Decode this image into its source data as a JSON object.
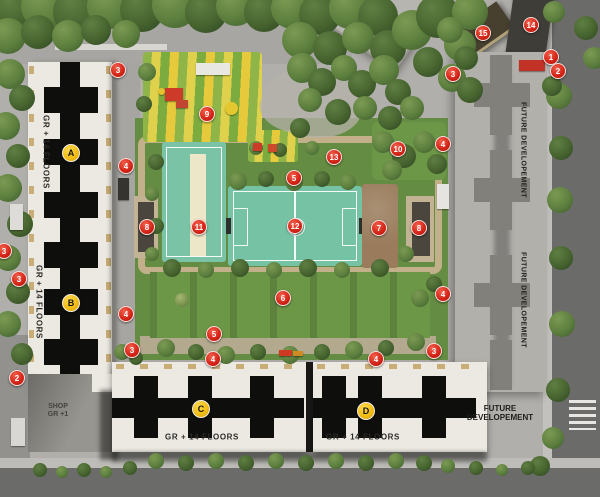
{
  "texts": {
    "floors_label": "GR + 14 FLOORS",
    "shop_line1": "SHOP",
    "shop_line2": "GR +1",
    "future_vertical": "FUTURE DEVELOPEMENT",
    "future_line1": "FUTURE",
    "future_line2": "DEVELOPEMENT"
  },
  "markers": {
    "numbers": [
      {
        "label": "1",
        "x": 550,
        "y": 56
      },
      {
        "label": "2",
        "x": 557,
        "y": 70
      },
      {
        "label": "2",
        "x": 16,
        "y": 377
      },
      {
        "label": "3",
        "x": 117,
        "y": 69
      },
      {
        "label": "3",
        "x": 452,
        "y": 73
      },
      {
        "label": "3",
        "x": 3,
        "y": 250
      },
      {
        "label": "3",
        "x": 18,
        "y": 278
      },
      {
        "label": "3",
        "x": 131,
        "y": 349
      },
      {
        "label": "3",
        "x": 433,
        "y": 350
      },
      {
        "label": "4",
        "x": 125,
        "y": 165
      },
      {
        "label": "4",
        "x": 125,
        "y": 313
      },
      {
        "label": "4",
        "x": 442,
        "y": 143
      },
      {
        "label": "4",
        "x": 442,
        "y": 293
      },
      {
        "label": "4",
        "x": 212,
        "y": 358
      },
      {
        "label": "4",
        "x": 375,
        "y": 358
      },
      {
        "label": "5",
        "x": 293,
        "y": 177
      },
      {
        "label": "5",
        "x": 213,
        "y": 333
      },
      {
        "label": "6",
        "x": 282,
        "y": 297
      },
      {
        "label": "7",
        "x": 378,
        "y": 227
      },
      {
        "label": "8",
        "x": 146,
        "y": 226
      },
      {
        "label": "8",
        "x": 418,
        "y": 227
      },
      {
        "label": "9",
        "x": 206,
        "y": 113
      },
      {
        "label": "10",
        "x": 397,
        "y": 148
      },
      {
        "label": "11",
        "x": 198,
        "y": 226
      },
      {
        "label": "12",
        "x": 294,
        "y": 225
      },
      {
        "label": "13",
        "x": 333,
        "y": 156
      },
      {
        "label": "14",
        "x": 530,
        "y": 24
      },
      {
        "label": "15",
        "x": 482,
        "y": 32
      }
    ],
    "letters": [
      {
        "label": "A",
        "x": 70,
        "y": 152
      },
      {
        "label": "B",
        "x": 70,
        "y": 302
      },
      {
        "label": "C",
        "x": 200,
        "y": 408
      },
      {
        "label": "D",
        "x": 365,
        "y": 410
      }
    ]
  },
  "colors": {
    "marker_red": "#d6271a",
    "marker_yellow": "#efba10",
    "court_teal": "#7ac3a7",
    "pitch_teal": "#76c2a5",
    "cream_strip": "#eee6c8",
    "lawn_green": "#6c9747",
    "playground_yellow": "#ddd14b",
    "playground_green": "#8ab447",
    "sand_brown": "#9a7c5c",
    "road_grey": "#6b6b69",
    "building_white": "#ece9e2",
    "tower_core_black": "#0e0e0c",
    "future_building_grey": "#b2b0ab",
    "stone_path": "#c1b08a"
  },
  "scene": {
    "trees": [
      [
        15,
        10,
        22,
        2
      ],
      [
        45,
        6,
        24,
        1
      ],
      [
        78,
        12,
        25,
        2
      ],
      [
        110,
        6,
        23,
        1
      ],
      [
        142,
        10,
        22,
        2
      ],
      [
        175,
        5,
        23,
        1
      ],
      [
        206,
        12,
        21,
        2
      ],
      [
        236,
        6,
        20,
        1
      ],
      [
        264,
        12,
        20,
        2
      ],
      [
        292,
        8,
        21,
        1
      ],
      [
        320,
        14,
        21,
        2
      ],
      [
        350,
        8,
        21,
        1
      ],
      [
        378,
        16,
        20,
        2
      ],
      [
        8,
        36,
        18,
        1
      ],
      [
        38,
        32,
        17,
        2
      ],
      [
        68,
        36,
        16,
        1
      ],
      [
        96,
        30,
        15,
        2
      ],
      [
        126,
        34,
        14,
        1
      ],
      [
        300,
        40,
        18,
        1
      ],
      [
        330,
        48,
        17,
        2
      ],
      [
        358,
        38,
        16,
        1
      ],
      [
        388,
        48,
        18,
        2
      ],
      [
        412,
        30,
        20,
        1
      ],
      [
        438,
        16,
        22,
        2
      ],
      [
        460,
        45,
        16,
        1
      ],
      [
        470,
        12,
        18,
        1
      ],
      [
        428,
        62,
        15,
        2
      ],
      [
        452,
        78,
        14,
        1
      ],
      [
        470,
        90,
        13,
        2
      ],
      [
        302,
        68,
        15,
        1
      ],
      [
        322,
        82,
        14,
        2
      ],
      [
        344,
        68,
        13,
        1
      ],
      [
        362,
        84,
        14,
        2
      ],
      [
        384,
        70,
        15,
        1
      ],
      [
        398,
        92,
        13,
        2
      ],
      [
        310,
        100,
        12,
        1
      ],
      [
        338,
        112,
        13,
        2
      ],
      [
        365,
        108,
        12,
        1
      ],
      [
        390,
        118,
        12,
        2
      ],
      [
        412,
        108,
        12,
        1
      ],
      [
        300,
        128,
        10,
        2
      ],
      [
        383,
        142,
        11,
        1
      ],
      [
        404,
        156,
        12,
        2
      ],
      [
        424,
        142,
        11,
        1
      ],
      [
        437,
        164,
        10,
        2
      ],
      [
        392,
        170,
        10,
        1
      ],
      [
        10,
        74,
        15,
        1
      ],
      [
        22,
        98,
        13,
        2
      ],
      [
        6,
        126,
        14,
        1
      ],
      [
        18,
        156,
        12,
        2
      ],
      [
        8,
        188,
        14,
        1
      ],
      [
        20,
        224,
        13,
        2
      ],
      [
        8,
        258,
        13,
        1
      ],
      [
        18,
        292,
        12,
        2
      ],
      [
        8,
        324,
        13,
        1
      ],
      [
        22,
        354,
        11,
        2
      ],
      [
        559,
        96,
        13,
        1
      ],
      [
        561,
        148,
        12,
        2
      ],
      [
        560,
        200,
        13,
        1
      ],
      [
        561,
        258,
        12,
        2
      ],
      [
        562,
        324,
        13,
        1
      ],
      [
        558,
        390,
        12,
        2
      ],
      [
        553,
        438,
        11,
        1
      ],
      [
        540,
        466,
        10,
        2
      ],
      [
        450,
        30,
        13,
        1
      ],
      [
        466,
        58,
        12,
        2
      ],
      [
        554,
        12,
        11,
        1
      ],
      [
        586,
        28,
        12,
        2
      ],
      [
        594,
        58,
        11,
        1
      ],
      [
        552,
        86,
        10,
        2
      ],
      [
        238,
        181,
        9,
        1
      ],
      [
        266,
        179,
        8,
        2
      ],
      [
        294,
        182,
        9,
        1
      ],
      [
        322,
        179,
        8,
        2
      ],
      [
        348,
        182,
        8,
        1
      ],
      [
        156,
        162,
        8,
        2
      ],
      [
        152,
        194,
        7,
        1
      ],
      [
        156,
        226,
        8,
        2
      ],
      [
        152,
        254,
        7,
        1
      ],
      [
        172,
        268,
        9,
        2
      ],
      [
        206,
        270,
        8,
        1
      ],
      [
        240,
        268,
        9,
        2
      ],
      [
        274,
        270,
        8,
        1
      ],
      [
        308,
        268,
        9,
        2
      ],
      [
        342,
        270,
        8,
        1
      ],
      [
        380,
        268,
        9,
        2
      ],
      [
        406,
        254,
        8,
        1
      ],
      [
        166,
        348,
        9,
        1
      ],
      [
        196,
        352,
        8,
        2
      ],
      [
        226,
        355,
        9,
        1
      ],
      [
        258,
        352,
        8,
        2
      ],
      [
        290,
        355,
        9,
        1
      ],
      [
        322,
        352,
        8,
        2
      ],
      [
        354,
        350,
        9,
        1
      ],
      [
        386,
        348,
        8,
        2
      ],
      [
        416,
        342,
        9,
        1
      ],
      [
        182,
        300,
        7,
        3
      ],
      [
        420,
        298,
        9,
        1
      ],
      [
        434,
        284,
        8,
        2
      ],
      [
        256,
        148,
        7,
        1
      ],
      [
        280,
        150,
        7,
        2
      ],
      [
        312,
        148,
        7,
        1
      ],
      [
        147,
        72,
        9,
        1
      ],
      [
        144,
        104,
        8,
        2
      ],
      [
        122,
        352,
        8,
        1
      ],
      [
        136,
        358,
        7,
        2
      ],
      [
        40,
        470,
        7,
        2
      ],
      [
        62,
        472,
        6,
        1
      ],
      [
        84,
        470,
        7,
        2
      ],
      [
        106,
        472,
        6,
        1
      ],
      [
        130,
        468,
        7,
        2
      ],
      [
        156,
        461,
        8,
        1
      ],
      [
        186,
        463,
        8,
        2
      ],
      [
        216,
        461,
        8,
        1
      ],
      [
        246,
        463,
        8,
        2
      ],
      [
        276,
        461,
        8,
        1
      ],
      [
        306,
        463,
        8,
        2
      ],
      [
        336,
        461,
        8,
        1
      ],
      [
        366,
        463,
        8,
        2
      ],
      [
        396,
        461,
        8,
        1
      ],
      [
        424,
        463,
        8,
        2
      ],
      [
        448,
        466,
        7,
        1
      ],
      [
        476,
        468,
        7,
        2
      ],
      [
        502,
        470,
        6,
        1
      ],
      [
        528,
        468,
        7,
        2
      ]
    ],
    "objects": [
      {
        "x": 196,
        "y": 63,
        "w": 34,
        "h": 12,
        "color": "#e9e7e2",
        "name": "vehicle-white-top"
      },
      {
        "x": 118,
        "y": 178,
        "w": 11,
        "h": 22,
        "color": "#35342f",
        "name": "vehicle-dark-driveway"
      },
      {
        "x": 10,
        "y": 204,
        "w": 13,
        "h": 26,
        "color": "#dedcd8",
        "name": "vehicle-white-left"
      },
      {
        "x": 11,
        "y": 418,
        "w": 14,
        "h": 28,
        "color": "#d9d7d3",
        "name": "vehicle-van-left"
      },
      {
        "x": 437,
        "y": 184,
        "w": 12,
        "h": 25,
        "color": "#e6e4e0",
        "name": "vehicle-white-right"
      },
      {
        "x": 519,
        "y": 60,
        "w": 26,
        "h": 11,
        "color": "#c23227",
        "name": "vehicle-red-topright"
      },
      {
        "x": 279,
        "y": 350,
        "w": 13,
        "h": 6,
        "color": "#cf3a22",
        "name": "bench-red"
      },
      {
        "x": 293,
        "y": 351,
        "w": 10,
        "h": 5,
        "color": "#cf8a22",
        "name": "bench-yellow"
      },
      {
        "x": 165,
        "y": 88,
        "w": 18,
        "h": 13,
        "color": "#cd3b28",
        "name": "play-structure-large"
      },
      {
        "x": 176,
        "y": 100,
        "w": 12,
        "h": 8,
        "color": "#c24432",
        "name": "play-structure-slide"
      },
      {
        "x": 253,
        "y": 143,
        "w": 9,
        "h": 8,
        "color": "#cc3a28",
        "name": "play-structure-small-1"
      },
      {
        "x": 268,
        "y": 144,
        "w": 9,
        "h": 8,
        "color": "#cc4a2a",
        "name": "play-structure-small-2"
      },
      {
        "x": 158,
        "y": 88,
        "w": 7,
        "h": 7,
        "color": "#e3c12f",
        "round": true,
        "name": "play-spiral-yellow"
      },
      {
        "x": 225,
        "y": 102,
        "w": 13,
        "h": 13,
        "color": "#e5c72f",
        "round": true,
        "name": "umbrella-yellow"
      }
    ]
  }
}
